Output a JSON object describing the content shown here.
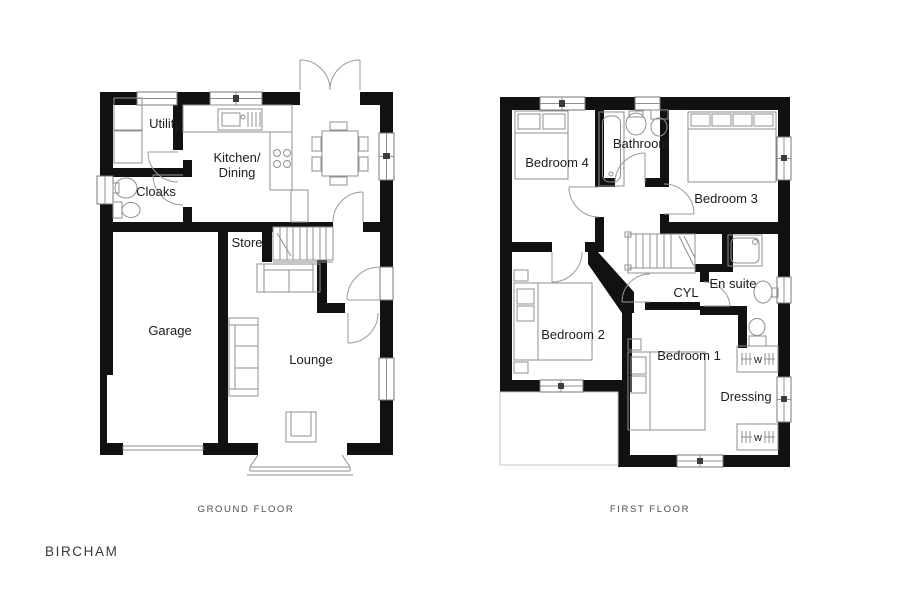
{
  "title": "BIRCHAM",
  "ground": {
    "caption": "GROUND FLOOR",
    "rooms": {
      "utility": "Utility",
      "cloaks": "Cloaks",
      "kitchen_line1": "Kitchen/",
      "kitchen_line2": "Dining",
      "store": "Store",
      "garage": "Garage",
      "lounge": "Lounge"
    }
  },
  "first": {
    "caption": "FIRST FLOOR",
    "rooms": {
      "bedroom4": "Bedroom 4",
      "bathroom": "Bathroom",
      "bedroom3": "Bedroom 3",
      "bedroom2": "Bedroom 2",
      "cyl": "CYL",
      "ensuite": "En suite",
      "bedroom1": "Bedroom 1",
      "dressing": "Dressing"
    },
    "wardrobe_label": "w"
  },
  "colors": {
    "wall": "#111111",
    "fixture_line": "#8f8f8f",
    "label_text": "#1d1d1d",
    "caption_text": "#4d4d4d",
    "background": "#ffffff"
  }
}
